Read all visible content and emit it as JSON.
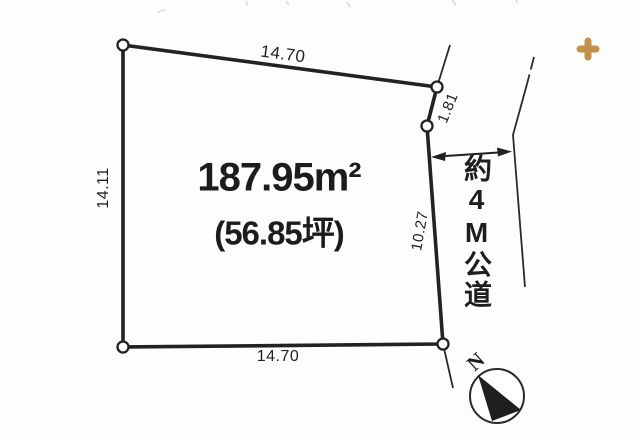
{
  "plot": {
    "area_m2": "187.95m²",
    "area_tsubo": "(56.85坪)",
    "dimensions": {
      "top": "14.70",
      "left": "14.11",
      "right_upper": "1.81",
      "right_lower": "10.27",
      "bottom": "14.70"
    }
  },
  "road": {
    "label": "約4M公道"
  },
  "compass": {
    "north": "N"
  },
  "colors": {
    "ink": "#222222",
    "background": "#fdfdfd",
    "cursor": "#c2914a"
  }
}
